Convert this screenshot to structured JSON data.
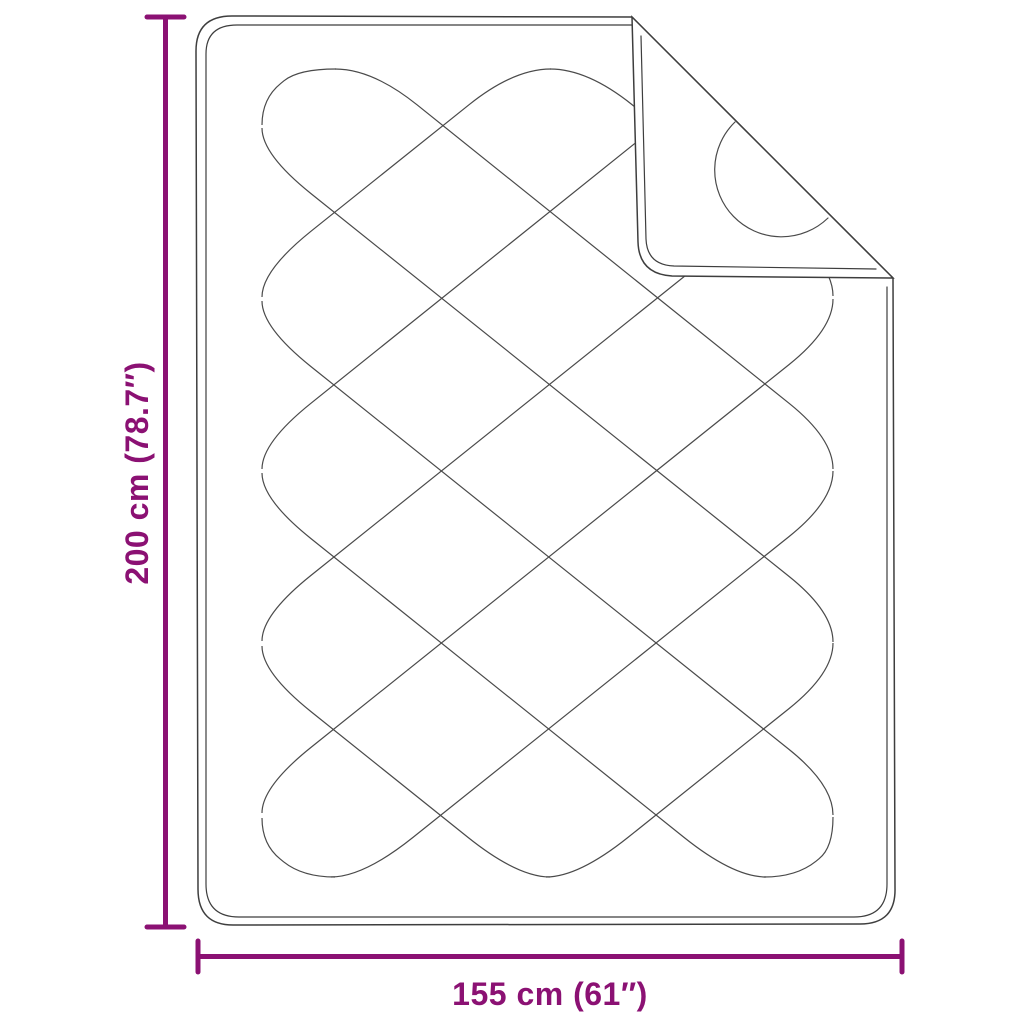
{
  "page": {
    "background": "#ffffff"
  },
  "diagram": {
    "kind": "blanket-dimension-diagram",
    "colors": {
      "accent": "#8B1173",
      "outline": "#3e3e3e",
      "pattern": "#4a4a4a",
      "surface": "#ffffff"
    },
    "dimensions": {
      "height": {
        "label": "200 cm (78.7″)"
      },
      "width": {
        "label": "155 cm (61″)"
      }
    }
  }
}
